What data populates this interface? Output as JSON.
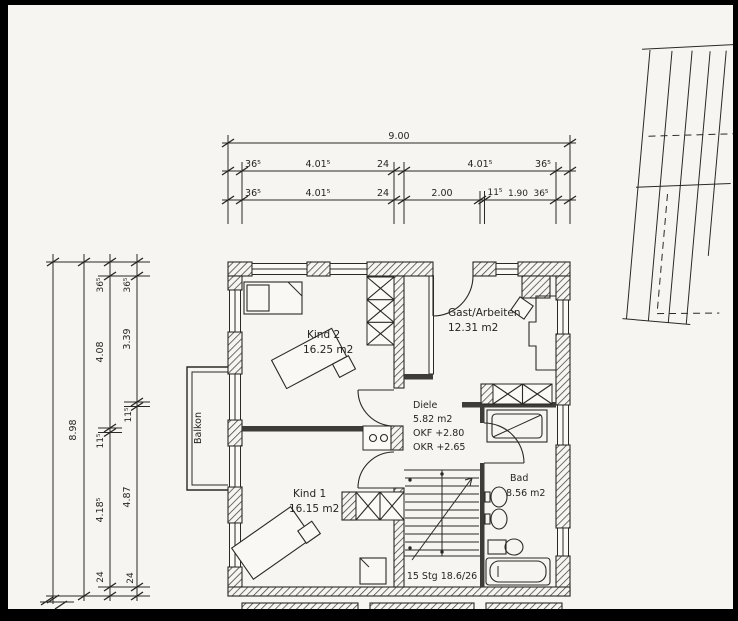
{
  "scan": {
    "paper_color": "#f6f5f1",
    "ink_color": "#2a2924",
    "border_color": "#000000"
  },
  "dims_top": {
    "total": "9.00",
    "row2": [
      "36⁵",
      "4.01⁵",
      "24",
      "4.01⁵",
      "36⁵"
    ],
    "row3": [
      "36⁵",
      "4.01⁵",
      "24",
      "2.00",
      "11⁵",
      "1.90",
      "36⁵"
    ]
  },
  "dims_left": {
    "total": "8.98",
    "inner": [
      "36⁵",
      "4.08",
      "11⁵",
      "4.18⁵",
      "24"
    ],
    "outer": [
      "36⁵",
      "3.39",
      "11⁵",
      "4.87",
      "24"
    ]
  },
  "rooms": {
    "kind2": {
      "name": "Kind 2",
      "area": "16.25 m2"
    },
    "gast": {
      "name": "Gast/Arbeiten",
      "area": "12.31 m2"
    },
    "diele": {
      "name": "Diele",
      "area": "5.82 m2",
      "okf": "OKF +2.80",
      "okr": "OKR +2.65"
    },
    "kind1": {
      "name": "Kind 1",
      "area": "16.15 m2"
    },
    "bad": {
      "name": "Bad",
      "area": "8.56 m2"
    }
  },
  "balkon_label": "Balkon",
  "stairs_label": "15 Stg 18.6/26"
}
